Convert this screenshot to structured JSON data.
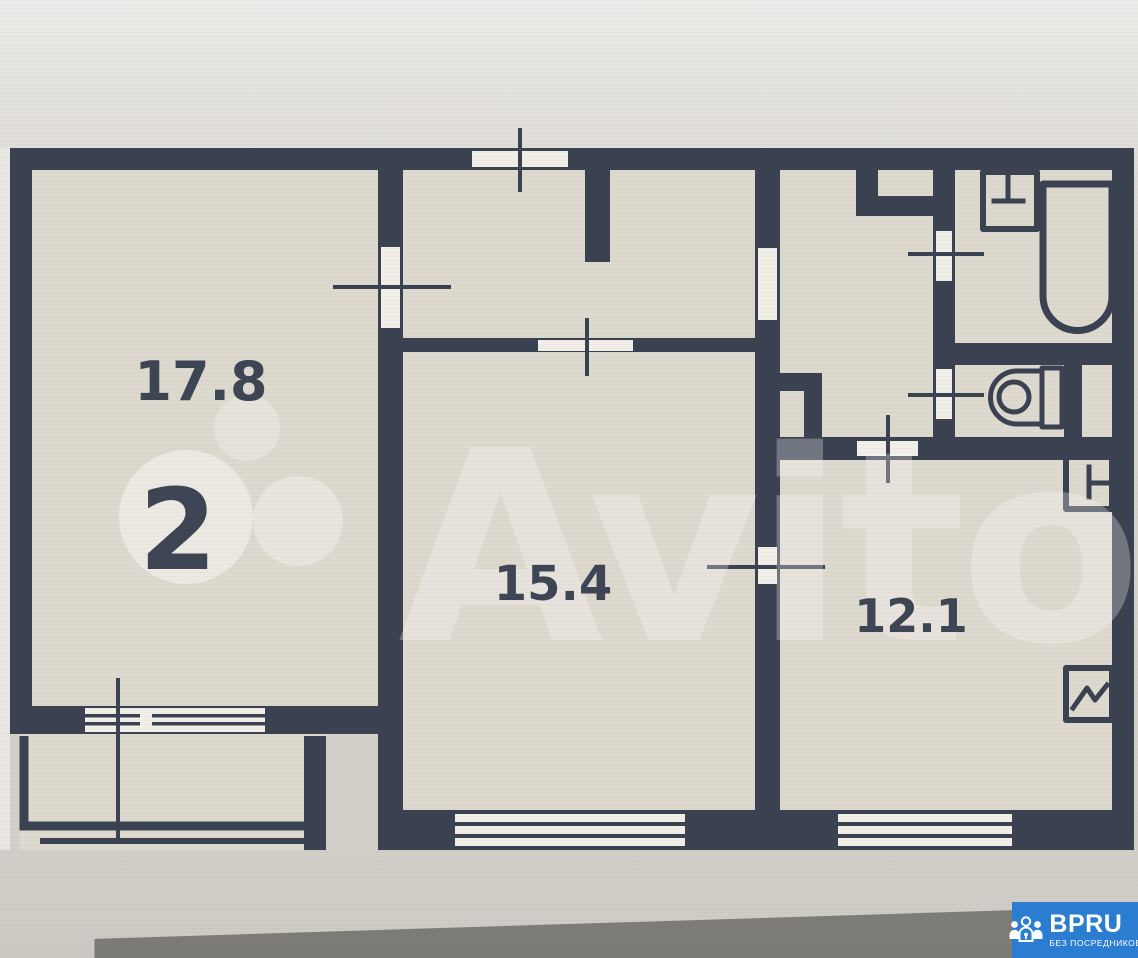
{
  "plan": {
    "room_count_badge": "2",
    "rooms": [
      {
        "id": "room-17-8",
        "area": "17.8"
      },
      {
        "id": "room-15-4",
        "area": "15.4"
      },
      {
        "id": "room-12-1",
        "area": "12.1"
      }
    ]
  },
  "watermark": {
    "brand": "Avito"
  },
  "logo": {
    "title": "BPRU",
    "subtitle": "БЕЗ ПОСРЕДНИКОВ"
  },
  "colors": {
    "wall": "#3a4150",
    "floor": "#ded9cf",
    "bg": "#d4d1ca",
    "opening": "#f2efe9",
    "label": "#3d4453",
    "logo-blue": "#2b7dd1",
    "logo-text": "#ffffff"
  }
}
